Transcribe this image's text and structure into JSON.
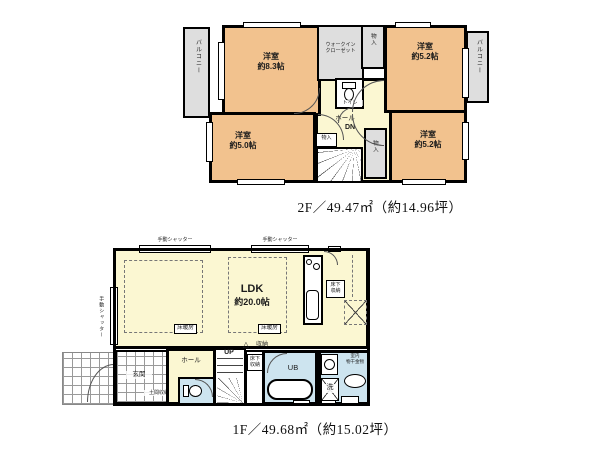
{
  "colors": {
    "room_orange": "#f2c28e",
    "room_yellow": "#fbf7d2",
    "area_gray": "#dedede",
    "wet_blue": "#cde4ef",
    "wall": "#000000",
    "tile_line": "#9a9a9a"
  },
  "floor2": {
    "caption": "2F／49.47㎡（約14.96坪）",
    "balcony_left": "バルコニー",
    "balcony_right": "バルコニー",
    "room_nw": {
      "name": "洋室",
      "size": "約8.3帖"
    },
    "room_ne": {
      "name": "洋室",
      "size": "約5.2帖"
    },
    "room_sw": {
      "name": "洋室",
      "size": "約5.0帖"
    },
    "room_se": {
      "name": "洋室",
      "size": "約5.2帖"
    },
    "wic": {
      "line1": "ウォークイン",
      "line2": "クローゼット"
    },
    "closet_top": "物入",
    "toilet": "トイレ",
    "hall": "ホール",
    "dn": "DN",
    "closet_stairs": "物入",
    "closet_side": "物入"
  },
  "floor1": {
    "caption": "1F／49.68㎡（約15.02坪）",
    "shutter_top_left": "手動シャッター",
    "shutter_top_right": "手動シャッター",
    "shutter_side": "手動シャッター",
    "ldk": {
      "name": "LDK",
      "size": "約20.0帖"
    },
    "floor_heating_left": "床暖房",
    "floor_heating_right": "床暖房",
    "underfloor_kitchen": {
      "line1": "床下",
      "line2": "収納"
    },
    "underfloor_hall": {
      "line1": "床下",
      "line2": "収納"
    },
    "genkan": "玄関",
    "doma_storage": "土間収納",
    "hall": "ホール",
    "up": "UP",
    "door_mark": "△",
    "storage": "収納",
    "ub": "UB",
    "washer": "洗",
    "indoor_drying": {
      "line1": "室内",
      "line2": "物干金物"
    }
  }
}
